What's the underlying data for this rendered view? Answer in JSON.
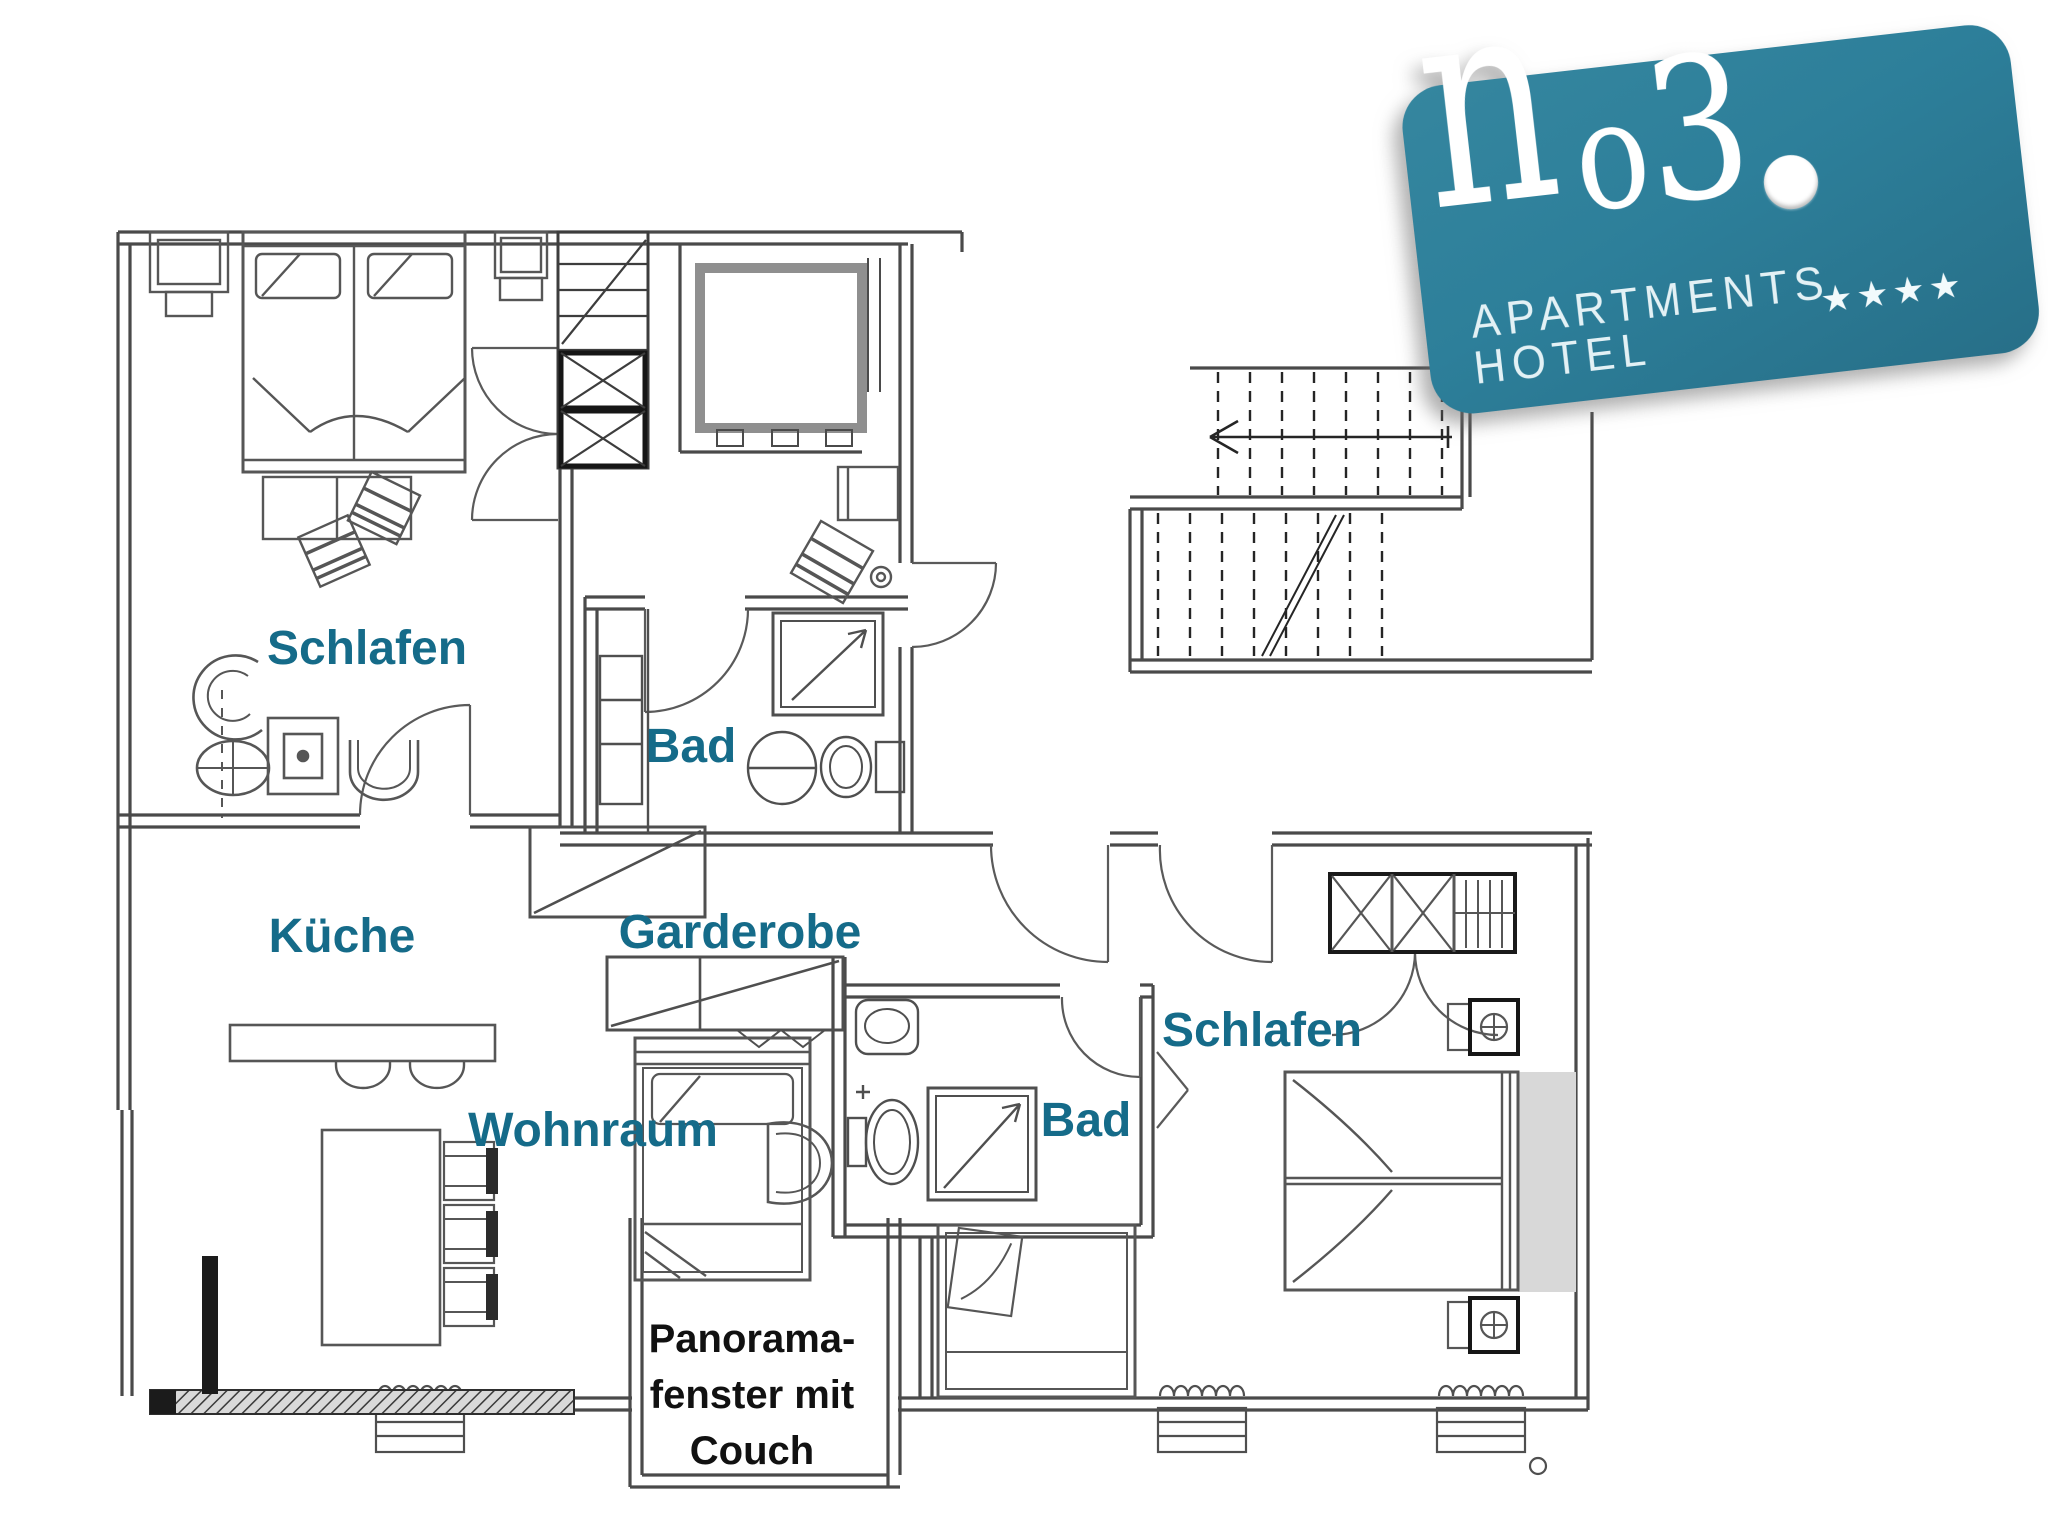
{
  "logo": {
    "monogram_n": "n",
    "monogram_o3_small": "o",
    "monogram_o3_big": "3",
    "line1": "APARTMENTS",
    "line2": "HOTEL",
    "stars": "★★★★",
    "bg_color": "#2d7f9a",
    "text_color": "#ffffff"
  },
  "labels": {
    "room_color": "#156b89",
    "annotation_color": "#111111",
    "rooms": [
      {
        "id": "schlafen-left",
        "text": "Schlafen"
      },
      {
        "id": "bad-left",
        "text": "Bad"
      },
      {
        "id": "kueche",
        "text": "Küche"
      },
      {
        "id": "garderobe",
        "text": "Garderobe"
      },
      {
        "id": "wohnraum",
        "text": "Wohnraum"
      },
      {
        "id": "schlafen-right",
        "text": "Schlafen"
      },
      {
        "id": "bad-right",
        "text": "Bad"
      }
    ],
    "annotation": {
      "lines": [
        "Panorama-",
        "fenster mit",
        "Couch"
      ]
    }
  }
}
